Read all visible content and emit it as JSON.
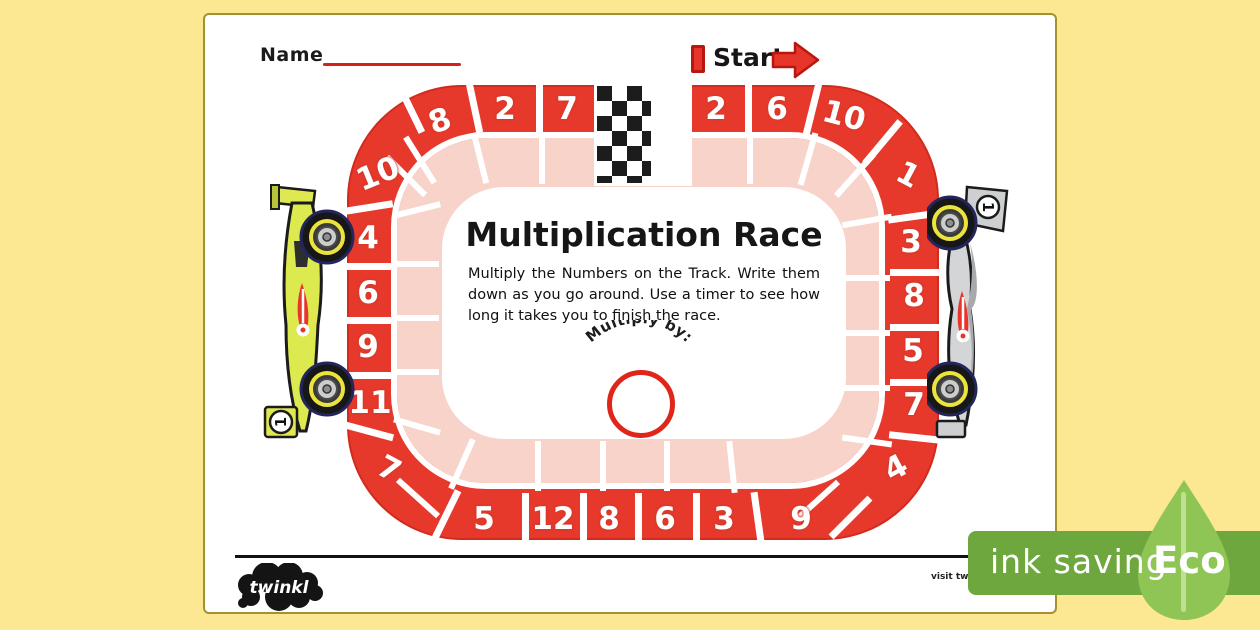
{
  "page": {
    "name_label": "Name",
    "start_label": "Start"
  },
  "infield": {
    "title": "Multiplication Race",
    "instructions": "Multiply the Numbers on the Track. Write them down as you go around. Use a timer to see how long it takes you to finish the race.",
    "multiply_by_label": "Multiply by:"
  },
  "track": {
    "cells": [
      "2",
      "6",
      "10",
      "1",
      "3",
      "8",
      "5",
      "7",
      "4",
      "9",
      "3",
      "6",
      "8",
      "12",
      "5",
      "7",
      "11",
      "9",
      "6",
      "4",
      "10",
      "8",
      "2",
      "7"
    ]
  },
  "cars": {
    "left_number": "1",
    "right_number": "1"
  },
  "footer": {
    "brand": "twinkl",
    "visit_text": "visit twinkl"
  },
  "eco": {
    "ink_saving": "ink saving",
    "label": "Eco"
  },
  "colors": {
    "track_red": "#e6392c",
    "track_pink": "#f8d3ca",
    "background_yellow": "#fce892",
    "eco_green": "#6fa73f",
    "eco_leaf_green": "#8fc554",
    "accent_red": "#d6201a"
  }
}
